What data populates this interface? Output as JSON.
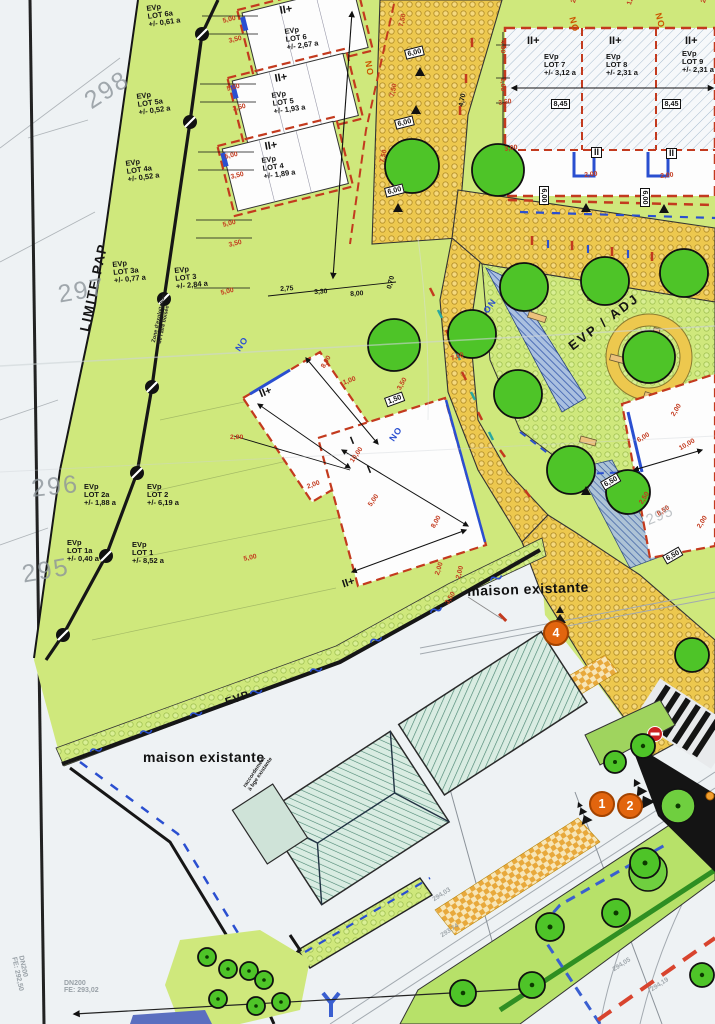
{
  "map": {
    "plan_type": "site development plan",
    "region_labels": {
      "limite_pap": "LIMITE PAP",
      "evp_adj": "EVP / ADJ",
      "evp_strip": "EVP",
      "maison_existante_1": "maison existante",
      "maison_existante_2": "maison existante"
    },
    "notes": {
      "zone": {
        "l1": "Zone d'exploitation",
        "l2": "de l'aire boisée"
      },
      "raccordement": {
        "l1": "raccordement",
        "l2": "à bge existante"
      }
    },
    "lots": [
      {
        "evp": "EVp",
        "name": "LOT 6a",
        "area": "+/- 0,61 a"
      },
      {
        "evp": "EVp",
        "name": "LOT 6",
        "area": "+/- 2,67 a"
      },
      {
        "evp": "EVp",
        "name": "LOT 5a",
        "area": "+/- 0,52 a"
      },
      {
        "evp": "EVp",
        "name": "LOT 5",
        "area": "+/- 1,93 a"
      },
      {
        "evp": "EVp",
        "name": "LOT 4a",
        "area": "+/- 0,52 a"
      },
      {
        "evp": "EVp",
        "name": "LOT 4",
        "area": "+/- 1,89 a"
      },
      {
        "evp": "EVp",
        "name": "LOT 3a",
        "area": "+/- 0,77 a"
      },
      {
        "evp": "EVp",
        "name": "LOT 3",
        "area": "+/- 2,84 a"
      },
      {
        "evp": "EVp",
        "name": "LOT 2a",
        "area": "+/- 1,88 a"
      },
      {
        "evp": "EVp",
        "name": "LOT 2",
        "area": "+/- 6,19 a"
      },
      {
        "evp": "EVp",
        "name": "LOT 1a",
        "area": "+/- 0,40 a"
      },
      {
        "evp": "EVp",
        "name": "LOT 1",
        "area": "+/- 8,52 a"
      },
      {
        "evp": "EVp",
        "name": "LOT 7",
        "area": "+/- 3,12 a"
      },
      {
        "evp": "EVp",
        "name": "LOT 8",
        "area": "+/- 2,31 a"
      },
      {
        "evp": "EVp",
        "name": "LOT 9",
        "area": "+/- 2,31 a"
      }
    ],
    "storeys": [
      "II+",
      "II+",
      "II+",
      "II+",
      "II+",
      "II+",
      "II+",
      "II+",
      "I",
      "I"
    ],
    "storeys_boxed": [
      "II",
      "II"
    ],
    "orientation_red": [
      "NO",
      "NO",
      "NO"
    ],
    "orientation_blue": [
      "NO",
      "ON",
      "NO"
    ],
    "dims_red": [
      "5,00",
      "3,50",
      "5,00",
      "3,50",
      "5,00",
      "3,50",
      "5,00",
      "3,50",
      "5,00",
      "7,50",
      "7,50",
      "7,50",
      "2,50",
      "1,50",
      "2,50",
      "4,00",
      "2,00",
      "3,50",
      "3,00",
      "2,00",
      "2,00",
      "8,00",
      "1,00",
      "3,50",
      "10,00",
      "5,00",
      "2,00",
      "7,00",
      "8,00",
      "2,00",
      "3,50",
      "2,00",
      "5,00",
      "6,00",
      "10,00",
      "2,50",
      "8,50",
      "2,00",
      "2,00",
      "2,00"
    ],
    "dims_black": [
      "2,75",
      "3,30",
      "8,00",
      "0,70",
      "4,70"
    ],
    "dims_boxed": [
      "6,00",
      "6,00",
      "6,00",
      "8,45",
      "8,45",
      "6,00",
      "6,00",
      "6,50",
      "6,50",
      "1,50"
    ],
    "contours": [
      "298",
      "297",
      "296",
      "295",
      "295"
    ],
    "elevations": [
      "294,03",
      "293,74",
      "294,05",
      "294,19"
    ],
    "infrastructure": [
      {
        "l1": "DN200",
        "l2": "FE: 292,50"
      },
      {
        "l1": "DN200",
        "l2": "FE: 293,02"
      }
    ],
    "route_markers": [
      "4",
      "1",
      "2"
    ],
    "colors": {
      "green_area": "#cfe87c",
      "tree_green": "#4ec428",
      "street_orange": "#edc84e",
      "plaza_green": "#cfe87c",
      "red_dash": "#c33a1e",
      "blue_line": "#2a4fd0",
      "roof_teal": "#d9ece2",
      "marker_orange": "#e2650e",
      "swale_blue": "#aac0e0"
    }
  }
}
